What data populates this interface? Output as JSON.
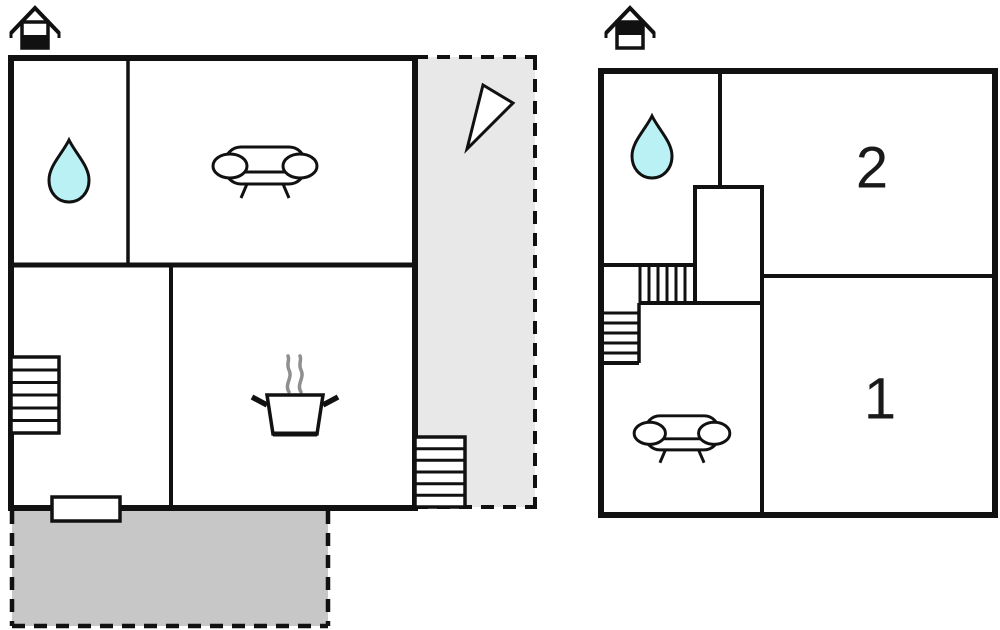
{
  "page": {
    "type": "floor-plan-diagram",
    "background": "#ffffff"
  },
  "colors": {
    "walls": "#111111",
    "water_drop": "#b9f1f4",
    "open_terrace_fill": "#e8e8e8",
    "covered_terrace_fill": "#c7c7c7",
    "steam": "#8f8f8f"
  },
  "floors": {
    "ground": {
      "icon": "house-ground-floor-icon",
      "features": [
        "water-drop-bathroom",
        "sofa-living-room",
        "cooking-pot-kitchen",
        "interior-staircase",
        "entrance-step",
        "exterior-steps",
        "north-arrow",
        "open-terrace",
        "covered-terrace"
      ]
    },
    "upper": {
      "icon": "house-upper-floor-icon",
      "features": [
        "water-drop-bathroom",
        "interior-staircase",
        "sofa-lounge"
      ],
      "rooms": [
        {
          "label": "1"
        },
        {
          "label": "2"
        }
      ]
    }
  }
}
